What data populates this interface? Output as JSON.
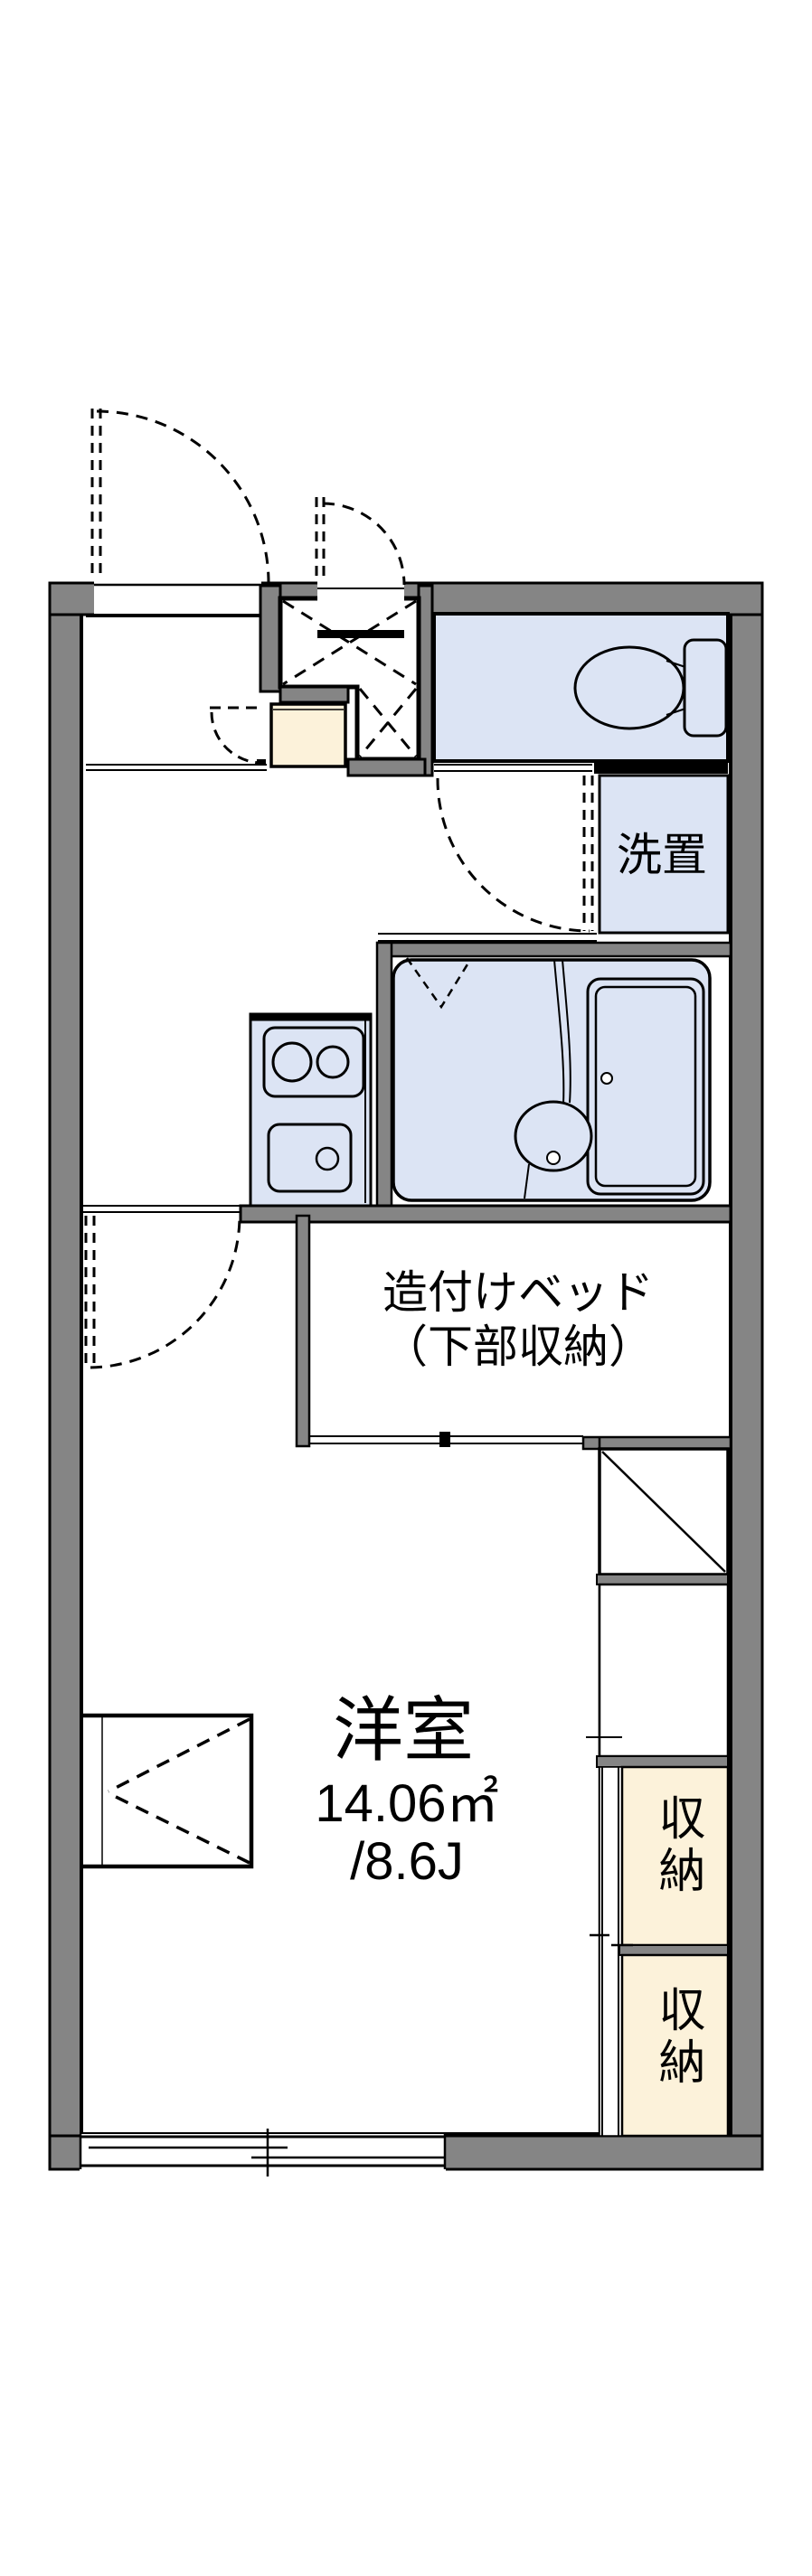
{
  "floor_plan": {
    "labels": {
      "washroom": "洗置",
      "built_in_bed_line1": "造付けベッド",
      "built_in_bed_line2": "（下部収納）",
      "main_room_name": "洋室",
      "main_room_area_sqm": "14.06㎡",
      "main_room_area_tatami": "/8.6J",
      "storage_upper": "収納",
      "storage_lower": "収納"
    },
    "colors": {
      "wall_gray": "#858585",
      "wet_area_blue": "#dce4f4",
      "storage_cream": "#fcf2da",
      "line_black": "#000000",
      "background_white": "#ffffff"
    }
  }
}
